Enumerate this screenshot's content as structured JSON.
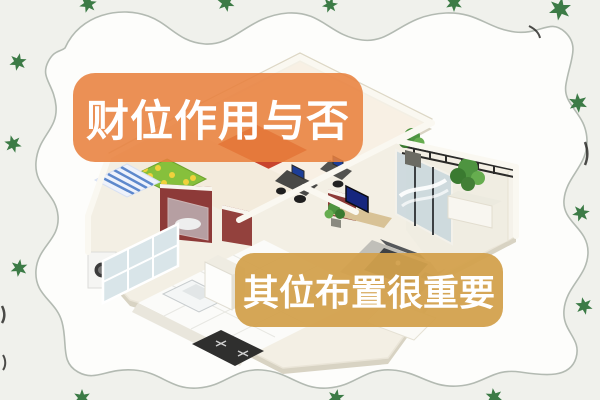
{
  "banners": {
    "top": {
      "text": "财位作用与否",
      "background": "#E8813E",
      "opacity": 0.88,
      "text_color": "#FFFFFF"
    },
    "bottom": {
      "text": "其位布置很重要",
      "background": "#D2A04B",
      "opacity": 0.94,
      "text_color": "#FFFFFF"
    }
  },
  "decor": {
    "border_style": "hand-drawn-wavy-frame",
    "wave_line_color": "#B3BAB2",
    "background_outside": "#F0F1EC",
    "background_inside": "#FDFDFB",
    "star_icon": "six-pointed-star",
    "star_color": "#3C7B46",
    "star_count": 14
  },
  "illustration": {
    "name": "isometric-apartment-floorplan",
    "elements": [
      "bedroom with green polka-dot bed",
      "blue striped rug",
      "dark-red bathroom walls with glass shower",
      "kitchen with tiled floor, sink and black cooktop",
      "washing machine and window wall",
      "red rug in top bedroom",
      "office desks with chairs and monitor",
      "living room with blue-screen tv, dark sofa and rug",
      "balcony with railing, plants and glass sliding doors"
    ],
    "colors": {
      "walls": "#FAF8F1",
      "wall_top": "#DDD7C5",
      "floor_base": "#F3EFE4",
      "bed_green": "#86C03C",
      "bed_dots_yellow": "#F0D23C",
      "rug_blue_stripe": "#5D88CC",
      "bathroom_red": "#8D3A38",
      "accent_rug_red": "#C8442E",
      "tv_screen_blue": "#16267E",
      "plant_green": "#4E9440",
      "furniture_dark": "#3E4144",
      "cooktop_black": "#2F2F2E"
    }
  }
}
